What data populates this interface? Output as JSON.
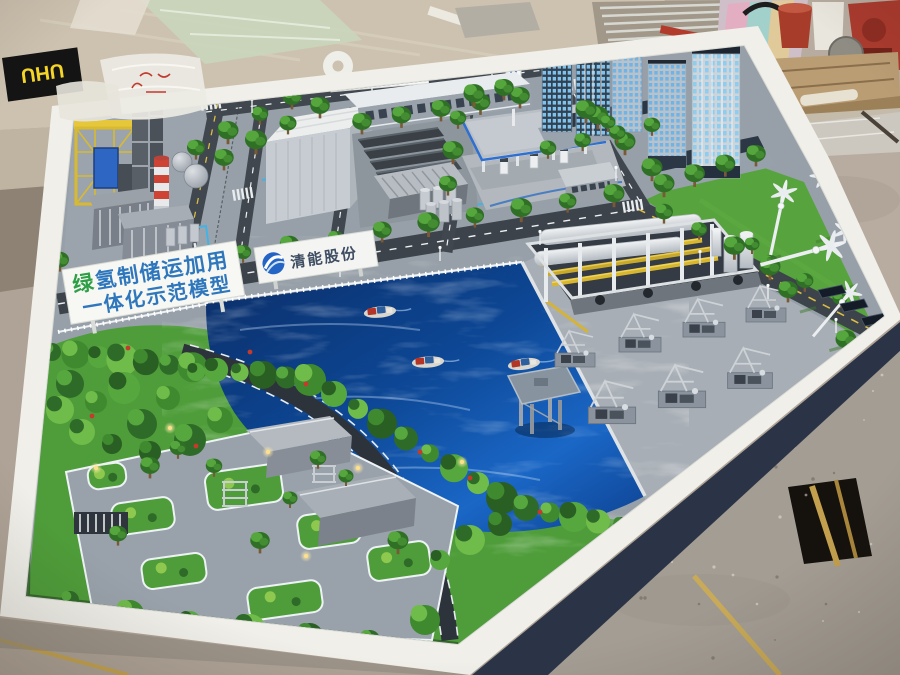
{
  "signs": {
    "park_banner": {
      "line1_first": "绿",
      "line1_rest": "氢制储运加用",
      "line2": "一体化示范模型",
      "text_blue": "#2f77bd",
      "text_green": "#2e9e47"
    },
    "company_board": {
      "name": "清能股份",
      "logo_color": "#2464c4"
    },
    "gate_billboard": {
      "company_cn": "豫氢动力",
      "company_en": "YUQING POWER",
      "logo_letter": "H",
      "logo_color": "#2565c8"
    },
    "station_sign": {
      "logo_letter": "H"
    },
    "workbench": {
      "glue_box_label": "UHU"
    }
  },
  "palette": {
    "water_deep": "#0b2d66",
    "water_mid": "#0d4795",
    "water_light": "#1a67c6",
    "lawn": "#4f9d3a",
    "road": "#3d434a",
    "concrete": "#97a0a8",
    "table_white": "#f0efe9",
    "table_side_navy": "#2b3447",
    "chimney_red": "#ce4333",
    "pipe_yellow": "#d7b631",
    "accent_blue": "#2e6fd0"
  }
}
